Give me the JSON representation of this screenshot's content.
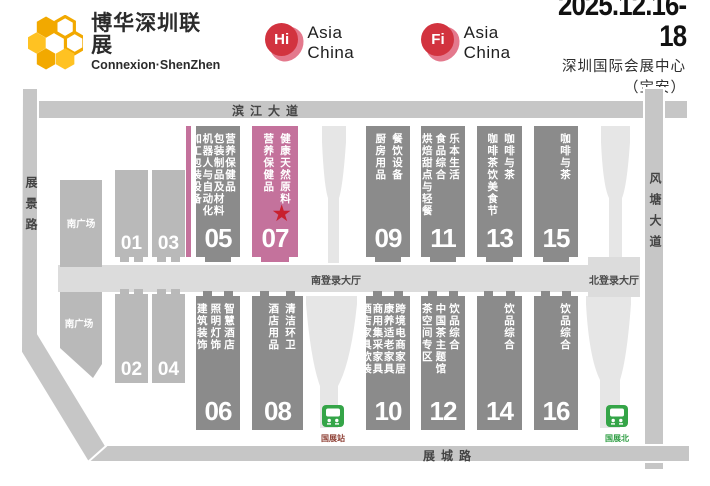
{
  "header": {
    "logo_title": "博华深圳联展",
    "logo_subtitle": "Connexion·ShenZhen",
    "badge_hi": {
      "short": "Hi",
      "label": "Asia China"
    },
    "badge_fi": {
      "short": "Fi",
      "label": "Asia China"
    },
    "date": "2025.12.16-18",
    "venue": "深圳国际会展中心（宝安）"
  },
  "map": {
    "roads": {
      "top": "滨江大道",
      "left": "展景路",
      "right": "风塘大道",
      "bottom": "展城路"
    },
    "lobbies": {
      "south": "南登录大厅",
      "north": "北登录大厅"
    },
    "plazas": {
      "upper": "南广场",
      "lower": "南广场"
    },
    "stations": {
      "left": "国展站",
      "right": "国展北"
    },
    "halls": {
      "h01": {
        "num": "01"
      },
      "h02": {
        "num": "02"
      },
      "h03": {
        "num": "03"
      },
      "h04": {
        "num": "04"
      },
      "h05": {
        "num": "05",
        "cats": "营养保健品\n包装制品及材料\n机器人与自动化\n加工包装设备"
      },
      "h06": {
        "num": "06",
        "cats": "智慧酒店\n照明灯饰\n建筑装饰"
      },
      "h07": {
        "num": "07",
        "cats": "健康天然原料\n营养保健品",
        "star": "★"
      },
      "h08": {
        "num": "08",
        "cats": "清洁环卫\n酒店用品"
      },
      "h09": {
        "num": "09",
        "cats": "餐饮设备\n厨房用品"
      },
      "h10": {
        "num": "10",
        "cats": "跨境电商家居\n康养适老家具\n商用集采家具\n酒店家具软装"
      },
      "h11": {
        "num": "11",
        "cats": "乐本生活\n食品综合\n烘焙甜点与轻餐"
      },
      "h12": {
        "num": "12",
        "cats": "饮品综合\n中国茶主题馆\n茶空间专区"
      },
      "h13": {
        "num": "13",
        "cats": "咖啡与茶\n咖啡茶饮美食节"
      },
      "h14": {
        "num": "14",
        "cats": "饮品综合"
      },
      "h15": {
        "num": "15",
        "cats": "咖啡与茶"
      },
      "h16": {
        "num": "16",
        "cats": "饮品综合"
      }
    },
    "colors": {
      "hall_gray": "#8b8b8b",
      "hall_light_gray": "#b9b9b9",
      "highlight_pink": "#c4729c",
      "star_red": "#c8202f",
      "road_gray": "#c6c6c6",
      "lobby_gray": "#dcdcdc",
      "corridor_gray": "#e6e6e6",
      "metro_green": "#35a548",
      "brand_yellow": "#f2a900",
      "brand_red": "#d2333f"
    }
  }
}
